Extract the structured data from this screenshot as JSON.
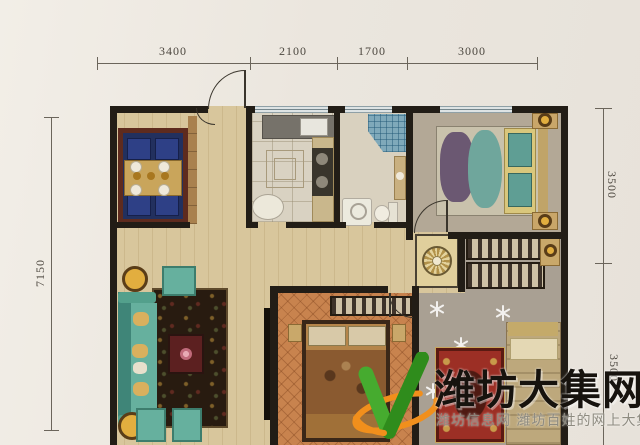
{
  "dimensions": {
    "top": [
      {
        "label": "3400"
      },
      {
        "label": "2100"
      },
      {
        "label": "1700"
      },
      {
        "label": "3000"
      }
    ],
    "left": {
      "label": "7150"
    },
    "right": [
      {
        "label": "3500"
      },
      {
        "label": "3500"
      }
    ]
  },
  "watermark": {
    "title": "潍坊大集网",
    "tagline": "潍坊信息网 潍坊百姓的网上大集",
    "logo_icon": "v-leaf-swoosh-logo",
    "colors": {
      "title": "#17130e",
      "tagline": "#8e8b80",
      "logo_green": "#3fa02a",
      "logo_green_dark": "#2f8c1c",
      "logo_orange": "#f18f1c"
    }
  },
  "plan": {
    "colors": {
      "wall": "#221d16",
      "wood_floor": "#d8c69c",
      "window": "#dde3e4",
      "sofa_teal": "#66b09e",
      "dining_rug_navy": "#22305e",
      "bedroom2_carpet_orange": "#c8834e",
      "bedroom3_rug_red": "#9c2f25",
      "bedroom1_carpet": "#b3a896",
      "bedroom3_carpet": "#a9a093"
    }
  }
}
